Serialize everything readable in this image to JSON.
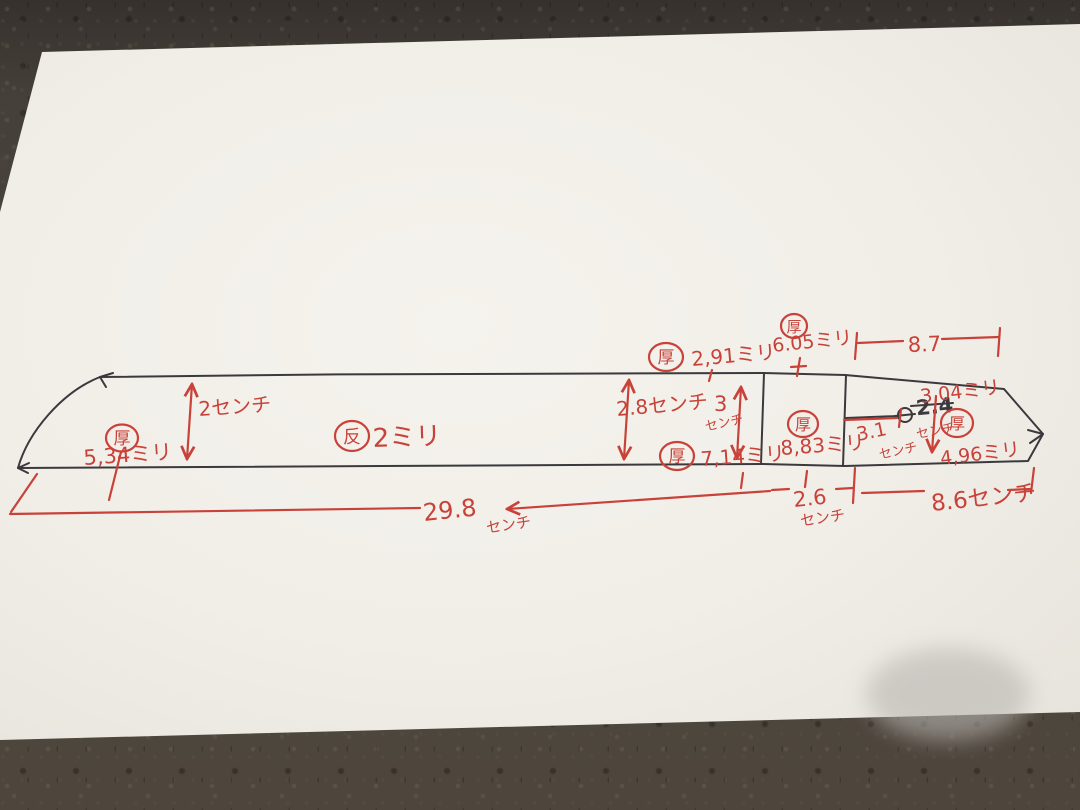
{
  "labels": {
    "atsu": "厚",
    "sori": "反"
  },
  "annotations": {
    "left_thickness": {
      "value": "5,34ミリ"
    },
    "left_height": {
      "value": "2センチ"
    },
    "sori_amount": {
      "value": "2ミリ"
    },
    "mid_height": {
      "value": "2.8センチ"
    },
    "spine_thickness_mid": {
      "value": "2,91ミリ"
    },
    "right_height": {
      "value": "3",
      "unit": "センチ"
    },
    "edge_thickness_mid": {
      "value": "7,14ミリ"
    },
    "spine_thickness_machi": {
      "value": "6.05ミリ"
    },
    "point_section_length": {
      "value": "8.7"
    },
    "machi_thickness": {
      "value": "8,83ミリ"
    },
    "machi_width": {
      "value": "2.6",
      "unit": "センチ"
    },
    "hole_offset": {
      "value": "3.1",
      "unit": "センチ"
    },
    "tip_spine_thickness": {
      "value": "3.04ミリ"
    },
    "crossed_width": {
      "value": "2.4",
      "unit": "センチ"
    },
    "tip_edge_thickness": {
      "value": "4,96ミリ"
    },
    "tang_length": {
      "value": "8.6センチ"
    },
    "total_length": {
      "value": "29.8",
      "unit": "センチ"
    }
  }
}
